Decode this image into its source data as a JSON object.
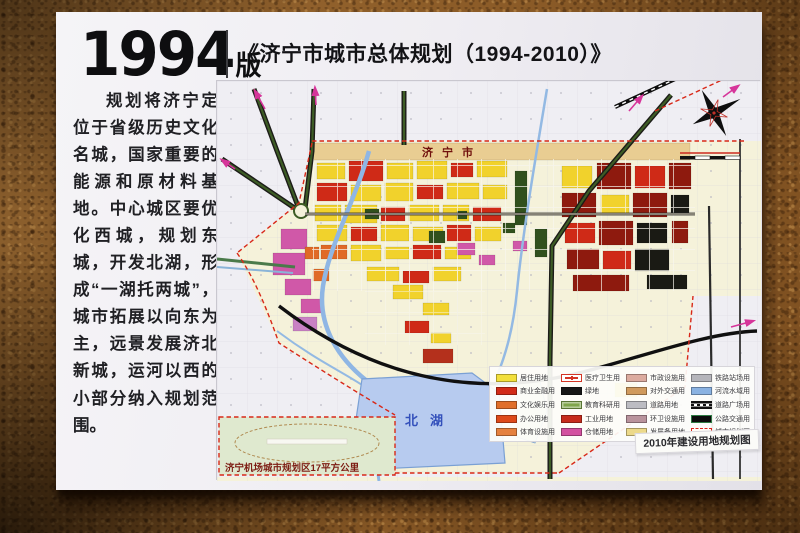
{
  "poster": {
    "edition_year": "1994",
    "edition_label": "版",
    "title": "《济宁市城市总体规划（1994-2010）》",
    "body_text": "规划将济宁定位于省级历史文化名城，国家重要的能源和原材料基地。中心城区要优化西城，规划东城，开发北湖，形成“一湖托两城”，城市拓展以向东为主，远景发展济北新城，运河以西的小部分纳入规划范围。"
  },
  "map": {
    "city_label": "济宁市",
    "lake_label": "北湖",
    "airport_note": "济宁机场城市规划区17平方公里",
    "legend_title": "2010年建设用地规划图",
    "legend_items": [
      {
        "label": "居住用地",
        "color": "#f2df3a",
        "style": "solid"
      },
      {
        "label": "商业金融用地",
        "color": "#d22b18",
        "style": "solid"
      },
      {
        "label": "文化娱乐用地",
        "color": "#e06f2a",
        "style": "solid"
      },
      {
        "label": "办公用地",
        "color": "#de4a1a",
        "style": "solid"
      },
      {
        "label": "体育设施用地",
        "color": "#e5813f",
        "style": "solid"
      },
      {
        "label": "医疗卫生用地",
        "color": "#ffffff",
        "style": "cross"
      },
      {
        "label": "绿地",
        "color": "#161616",
        "style": "solid"
      },
      {
        "label": "教育科研用地",
        "color": "#7fa64b",
        "style": "solid-inset"
      },
      {
        "label": "工业用地",
        "color": "#c62b1d",
        "style": "solid"
      },
      {
        "label": "仓储用地",
        "color": "#d351a0",
        "style": "solid"
      },
      {
        "label": "市政设施用地",
        "color": "#dcab9f",
        "style": "solid"
      },
      {
        "label": "对外交通用地",
        "color": "#d09a5d",
        "style": "solid"
      },
      {
        "label": "道路用地",
        "color": "#bcbcc2",
        "style": "solid"
      },
      {
        "label": "环卫设施用地",
        "color": "#b9939c",
        "style": "solid"
      },
      {
        "label": "发展备用地",
        "color": "#ecd98a",
        "style": "solid"
      },
      {
        "label": "铁路站场用地",
        "color": "#b5b5bb",
        "style": "solid"
      },
      {
        "label": "河流水域用地",
        "color": "#8ab2e2",
        "style": "solid"
      },
      {
        "label": "道路广场用地",
        "color": "#111111",
        "style": "rail"
      },
      {
        "label": "公路交通用地",
        "color": "#0c0c0c",
        "style": "solid-outline"
      },
      {
        "label": "城市规划区界线",
        "color": "#ffffff",
        "style": "dashed"
      }
    ]
  }
}
